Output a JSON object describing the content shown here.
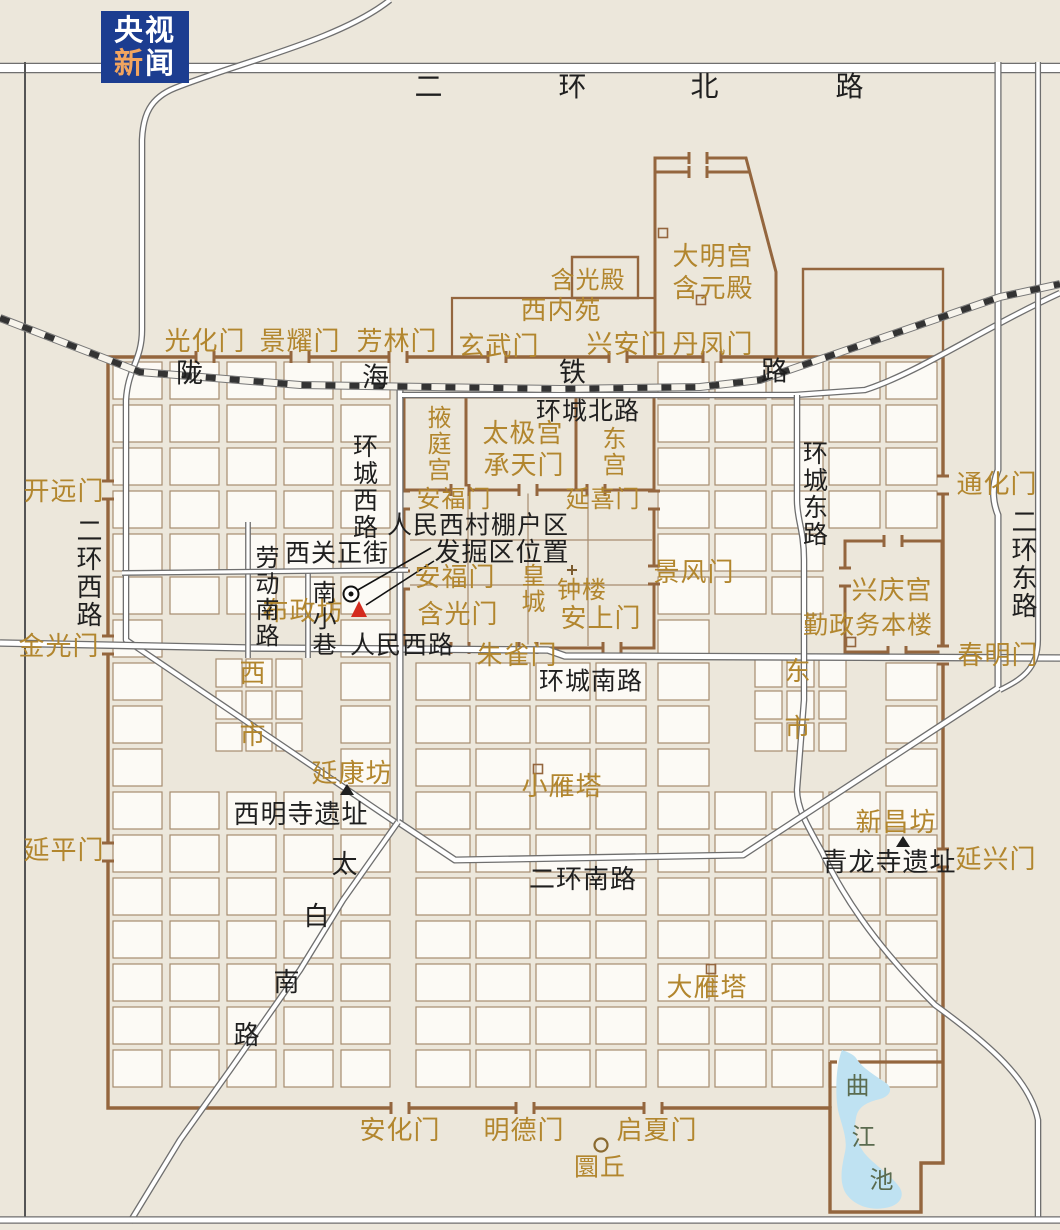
{
  "logo": {
    "line1": "央视",
    "line2_a": "新",
    "line2_b": "闻"
  },
  "colors": {
    "background": "#ece7db",
    "block_fill": "#fcfaf5",
    "block_stroke": "#a78c6f",
    "wall_brown": "#94663e",
    "label_gold": "#b2862e",
    "label_black": "#1f1f1f",
    "road_casing": "#6f6f6f",
    "road_fill": "#ffffff",
    "railway_black": "#333333",
    "lake_blue": "#bfe2f2",
    "lake_text": "#5a6b4f",
    "excavation_red": "#d42b1e",
    "logo_blue": "#1c3d90",
    "logo_orange": "#f2a55f"
  },
  "labels": [
    {
      "t": "光化门",
      "x": 205,
      "y": 342,
      "c": "g"
    },
    {
      "t": "景耀门",
      "x": 300,
      "y": 342,
      "c": "g"
    },
    {
      "t": "芳林门",
      "x": 397,
      "y": 342,
      "c": "g"
    },
    {
      "t": "玄武门",
      "x": 499,
      "y": 347,
      "c": "g"
    },
    {
      "t": "兴安门",
      "x": 627,
      "y": 345,
      "c": "g"
    },
    {
      "t": "丹凤门",
      "x": 713,
      "y": 345,
      "c": "g"
    },
    {
      "t": "含光殿",
      "x": 588,
      "y": 280,
      "c": "g",
      "s": 24
    },
    {
      "t": "大明宫",
      "x": 713,
      "y": 257,
      "c": "g"
    },
    {
      "t": "含元殿",
      "x": 713,
      "y": 289,
      "c": "g"
    },
    {
      "t": "西内苑",
      "x": 561,
      "y": 311,
      "c": "g"
    },
    {
      "t": "掖庭宫",
      "x": 437,
      "y": 444,
      "c": "g",
      "v": 1,
      "s": 24
    },
    {
      "t": "太极宫",
      "x": 523,
      "y": 434,
      "c": "g"
    },
    {
      "t": "承天门",
      "x": 524,
      "y": 466,
      "c": "g"
    },
    {
      "t": "东宫",
      "x": 612,
      "y": 452,
      "c": "g",
      "v": 1,
      "s": 24
    },
    {
      "t": "安福门",
      "x": 454,
      "y": 499,
      "c": "g",
      "s": 24
    },
    {
      "t": "延喜门",
      "x": 603,
      "y": 499,
      "c": "g",
      "s": 24
    },
    {
      "t": "开远门",
      "x": 64,
      "y": 492,
      "c": "g"
    },
    {
      "t": "通化门",
      "x": 997,
      "y": 485,
      "c": "g"
    },
    {
      "t": "金光门",
      "x": 59,
      "y": 647,
      "c": "g"
    },
    {
      "t": "春明门",
      "x": 998,
      "y": 656,
      "c": "g"
    },
    {
      "t": "延平门",
      "x": 64,
      "y": 851,
      "c": "g"
    },
    {
      "t": "延兴门",
      "x": 996,
      "y": 860,
      "c": "g"
    },
    {
      "t": "布政坊",
      "x": 303,
      "y": 612,
      "c": "g"
    },
    {
      "t": "安福门",
      "x": 455,
      "y": 578,
      "c": "g"
    },
    {
      "t": "含光门",
      "x": 458,
      "y": 615,
      "c": "g"
    },
    {
      "t": "朱雀门",
      "x": 517,
      "y": 656,
      "c": "g"
    },
    {
      "t": "景风门",
      "x": 694,
      "y": 573,
      "c": "g"
    },
    {
      "t": "皇城",
      "x": 531,
      "y": 589,
      "c": "g",
      "v": 1,
      "s": 24
    },
    {
      "t": "钟楼",
      "x": 582,
      "y": 590,
      "c": "g",
      "s": 24
    },
    {
      "t": "安上门",
      "x": 601,
      "y": 619,
      "c": "g"
    },
    {
      "t": "兴庆宫",
      "x": 892,
      "y": 591,
      "c": "g"
    },
    {
      "t": "勤政务本楼",
      "x": 868,
      "y": 625,
      "c": "g",
      "s": 25
    },
    {
      "t": "西",
      "x": 253,
      "y": 674,
      "c": "g"
    },
    {
      "t": "市",
      "x": 253,
      "y": 736,
      "c": "g"
    },
    {
      "t": "东",
      "x": 798,
      "y": 672,
      "c": "g"
    },
    {
      "t": "市",
      "x": 798,
      "y": 729,
      "c": "g"
    },
    {
      "t": "延康坊",
      "x": 352,
      "y": 774,
      "c": "g"
    },
    {
      "t": "小雁塔",
      "x": 562,
      "y": 787,
      "c": "g"
    },
    {
      "t": "新昌坊",
      "x": 896,
      "y": 823,
      "c": "g"
    },
    {
      "t": "大雁塔",
      "x": 707,
      "y": 988,
      "c": "g"
    },
    {
      "t": "安化门",
      "x": 400,
      "y": 1131,
      "c": "g"
    },
    {
      "t": "明德门",
      "x": 524,
      "y": 1131,
      "c": "g"
    },
    {
      "t": "启夏门",
      "x": 657,
      "y": 1131,
      "c": "g"
    },
    {
      "t": "圜丘",
      "x": 600,
      "y": 1167,
      "c": "g",
      "s": 25
    },
    {
      "t": "二",
      "x": 429,
      "y": 87,
      "c": "k",
      "s": 28
    },
    {
      "t": "环",
      "x": 573,
      "y": 87,
      "c": "k",
      "s": 28
    },
    {
      "t": "北",
      "x": 705,
      "y": 87,
      "c": "k",
      "s": 28
    },
    {
      "t": "路",
      "x": 850,
      "y": 87,
      "c": "k",
      "s": 28
    },
    {
      "t": "陇",
      "x": 190,
      "y": 374,
      "c": "k",
      "s": 27
    },
    {
      "t": "海",
      "x": 376,
      "y": 378,
      "c": "k",
      "s": 27
    },
    {
      "t": "铁",
      "x": 573,
      "y": 373,
      "c": "k",
      "s": 27
    },
    {
      "t": "路",
      "x": 775,
      "y": 372,
      "c": "k",
      "s": 27
    },
    {
      "t": "环城北路",
      "x": 588,
      "y": 411,
      "c": "k",
      "s": 25
    },
    {
      "t": "环城西路",
      "x": 364,
      "y": 487,
      "c": "k",
      "v": 1,
      "s": 25
    },
    {
      "t": "环城东路",
      "x": 814,
      "y": 494,
      "c": "k",
      "v": 1,
      "s": 25
    },
    {
      "t": "二环西路",
      "x": 87,
      "y": 573,
      "c": "k",
      "v": 1,
      "s": 26
    },
    {
      "t": "二环东路",
      "x": 1022,
      "y": 564,
      "c": "k",
      "v": 1,
      "s": 26
    },
    {
      "t": "劳动南路",
      "x": 265,
      "y": 597,
      "c": "k",
      "v": 1,
      "s": 24
    },
    {
      "t": "南小巷",
      "x": 322,
      "y": 619,
      "c": "k",
      "v": 1,
      "s": 24
    },
    {
      "t": "西关正街",
      "x": 337,
      "y": 553,
      "c": "k",
      "s": 25
    },
    {
      "t": "人民西村棚户区",
      "x": 478,
      "y": 525,
      "c": "k",
      "s": 25
    },
    {
      "t": "发掘区位置",
      "x": 502,
      "y": 553,
      "c": "k",
      "s": 26
    },
    {
      "t": "人民西路",
      "x": 402,
      "y": 645,
      "c": "k",
      "s": 25
    },
    {
      "t": "环城南路",
      "x": 591,
      "y": 681,
      "c": "k",
      "s": 25
    },
    {
      "t": "二环南路",
      "x": 583,
      "y": 880,
      "c": "k",
      "s": 26
    },
    {
      "t": "西明寺遗址",
      "x": 301,
      "y": 815,
      "c": "k",
      "s": 26
    },
    {
      "t": "青龙寺遗址",
      "x": 889,
      "y": 863,
      "c": "k",
      "s": 26
    },
    {
      "t": "太",
      "x": 345,
      "y": 865,
      "c": "k",
      "s": 26
    },
    {
      "t": "白",
      "x": 317,
      "y": 917,
      "c": "k",
      "s": 26
    },
    {
      "t": "南",
      "x": 287,
      "y": 983,
      "c": "k",
      "s": 26
    },
    {
      "t": "路",
      "x": 247,
      "y": 1036,
      "c": "k",
      "s": 26
    },
    {
      "t": "曲",
      "x": 858,
      "y": 1086,
      "c": "w",
      "s": 24
    },
    {
      "t": "江",
      "x": 864,
      "y": 1137,
      "c": "w",
      "s": 24
    },
    {
      "t": "池",
      "x": 882,
      "y": 1180,
      "c": "w",
      "s": 24
    }
  ],
  "markers": {
    "excavation_circle": [
      351,
      594
    ],
    "excavation_triangle": [
      359,
      610
    ],
    "leader_lines": [
      [
        431,
        548,
        356,
        591
      ],
      [
        434,
        561,
        366,
        605
      ]
    ],
    "fang_triangles": [
      [
        347,
        791
      ],
      [
        903,
        843
      ]
    ],
    "site_squares": [
      [
        538,
        769
      ],
      [
        711,
        969
      ],
      [
        663,
        233
      ],
      [
        701,
        300
      ],
      [
        851,
        642
      ]
    ],
    "zhonglou_cross": [
      572,
      570
    ],
    "huanqiu_circle": [
      601,
      1145
    ]
  }
}
